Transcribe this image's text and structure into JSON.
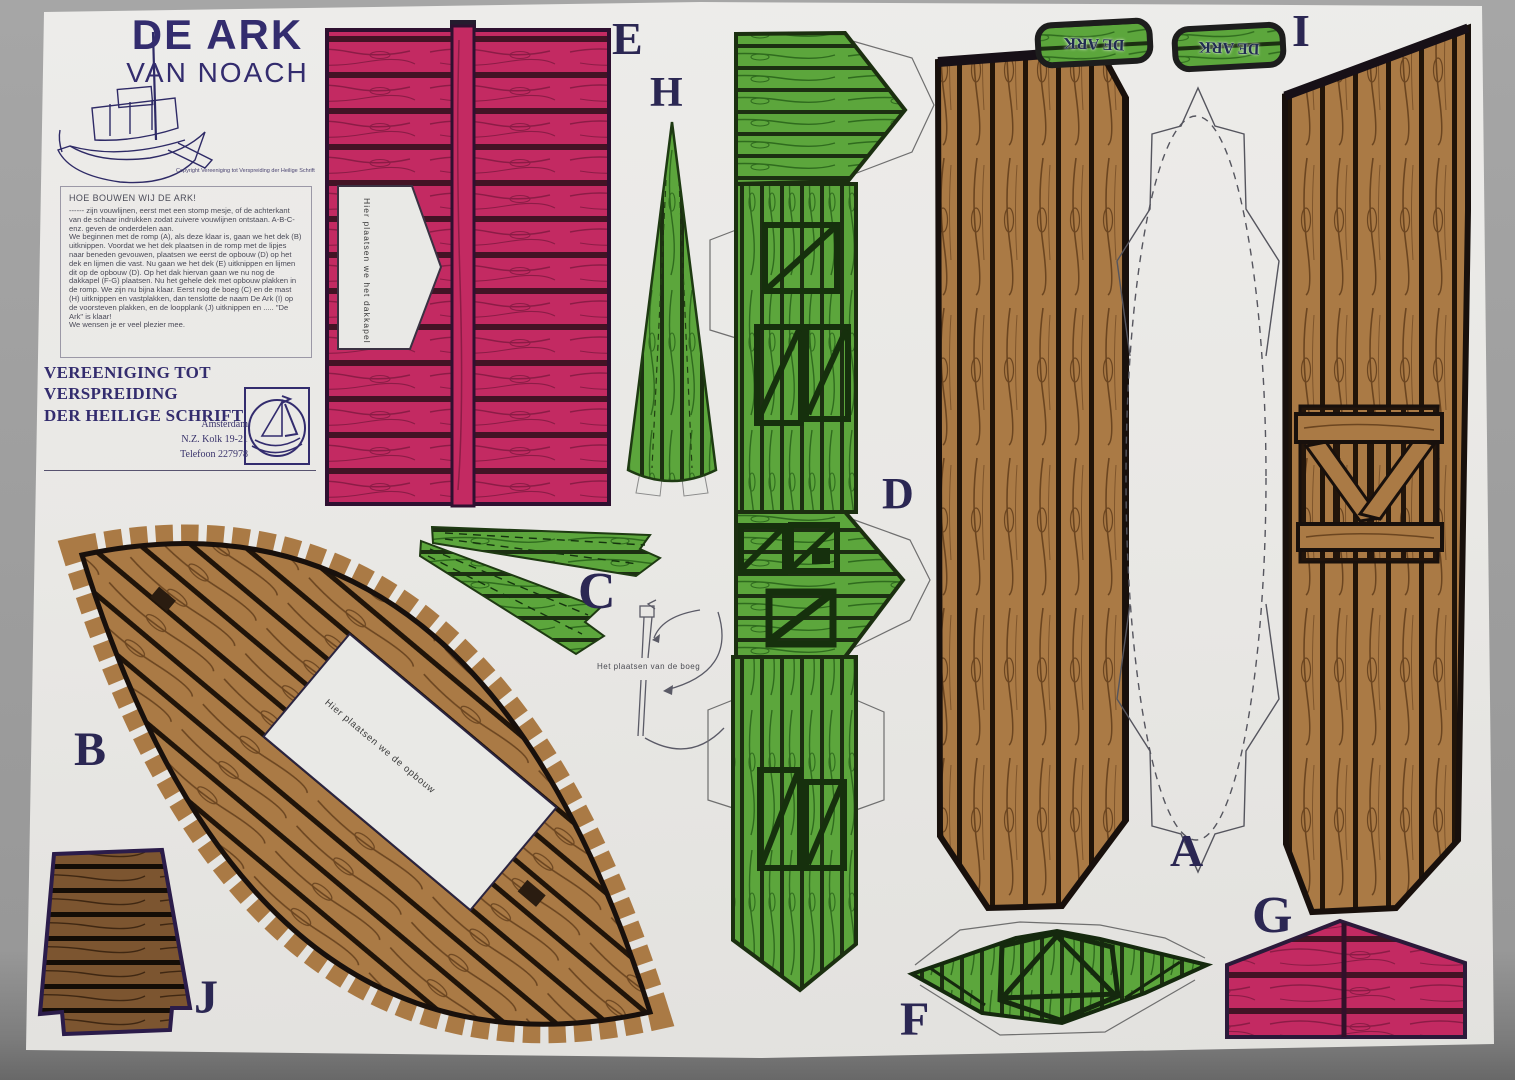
{
  "document": {
    "title_line1": "DE ARK",
    "title_line2": "VAN NOACH",
    "copyright": "Copyright Vereeniging tot Verspreiding der Heilige Schrift",
    "instructions_heading": "HOE BOUWEN WIJ DE ARK!",
    "instructions_body": "------ zijn vouwlijnen, eerst met een stomp mesje, of de achterkant van de schaar indrukken zodat zuivere vouwlijnen ontstaan. A-B-C- enz. geven de onderdelen aan.\nWe beginnen met de romp (A), als deze klaar is, gaan we het dek (B) uitknippen. Voordat we het dek plaatsen in de romp met de lipjes naar beneden gevouwen, plaatsen we eerst de opbouw (D) op het dek en lijmen die vast. Nu gaan we het dek (E) uitknippen en lijmen dit op de opbouw (D). Op het dak hiervan gaan we nu nog de dakkapel (F-G) plaatsen. Nu het gehele dek met opbouw plakken in de romp. We zijn nu bijna klaar. Eerst nog de boeg (C) en de mast (H) uitknippen en vastplakken, dan tenslotte de naam De Ark (I) op de voorsteven plakken, en de loopplank (J) uitknippen en ..... \"De Ark\" is klaar!\nWe wensen je er veel plezier mee.",
    "organization_line1": "VEREENIGING TOT VERSPREIDING",
    "organization_line2": "DER HEILIGE SCHRIFT",
    "address": {
      "city": "Amsterdam",
      "street": "N.Z. Kolk 19-21",
      "phone": "Telefoon 227978"
    }
  },
  "pieces": {
    "labels": {
      "A": "A",
      "B": "B",
      "C": "C",
      "D": "D",
      "E": "E",
      "F": "F",
      "G": "G",
      "H": "H",
      "I": "I",
      "J": "J"
    },
    "notes": {
      "roof_note": "Hier plaatsen we het dakkapel",
      "deck_note": "Hier plaatsen we de opbouw",
      "bow_caption": "Het plaatsen van de boeg",
      "name_plate": "DE ARK"
    }
  },
  "colors": {
    "backdrop": "#9c9c9c",
    "paper": "#e9e9e6",
    "ink_outline": "#241c26",
    "navy_text": "#332c6e",
    "letter_color": "#2b2753",
    "pink": "#c32a62",
    "pink_seam": "#431325",
    "pink_grain": "#8c1c46",
    "green": "#5ca63c",
    "green_seam": "#1c2f12",
    "green_grain": "#2f6b1e",
    "brown": "#aa7a45",
    "brown_seam": "#201409",
    "brown_grain": "#6b4520",
    "brown_dark": "#7c5530",
    "brown_dark_seam": "#140d06",
    "brown_dark_grain": "#3f2712"
  }
}
